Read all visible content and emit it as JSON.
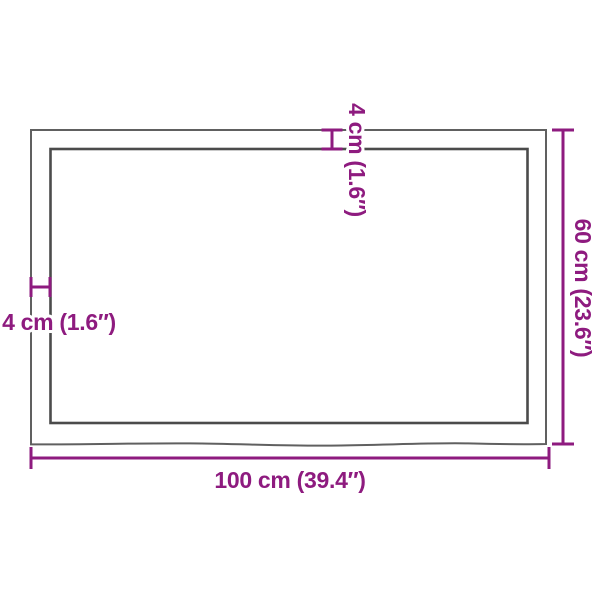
{
  "figure": {
    "type": "product-dimension-diagram",
    "subject": "rectangular tabletop, top view",
    "background": "#ffffff",
    "accent_color": "#8e1b7f",
    "outline_color": "#606060",
    "outline_inner_color": "#4b4b4b",
    "labels": {
      "width": "100 cm (39.4″)",
      "height": "60 cm (23.6″)",
      "thickness_top": "4 cm (1.6″)",
      "thickness_side": "4 cm (1.6″)"
    },
    "measurements": {
      "width_cm": 100,
      "width_inches": 39.4,
      "depth_cm": 60,
      "depth_inches": 23.6,
      "edge_thickness_cm": 4,
      "edge_thickness_inches": 1.6
    }
  }
}
